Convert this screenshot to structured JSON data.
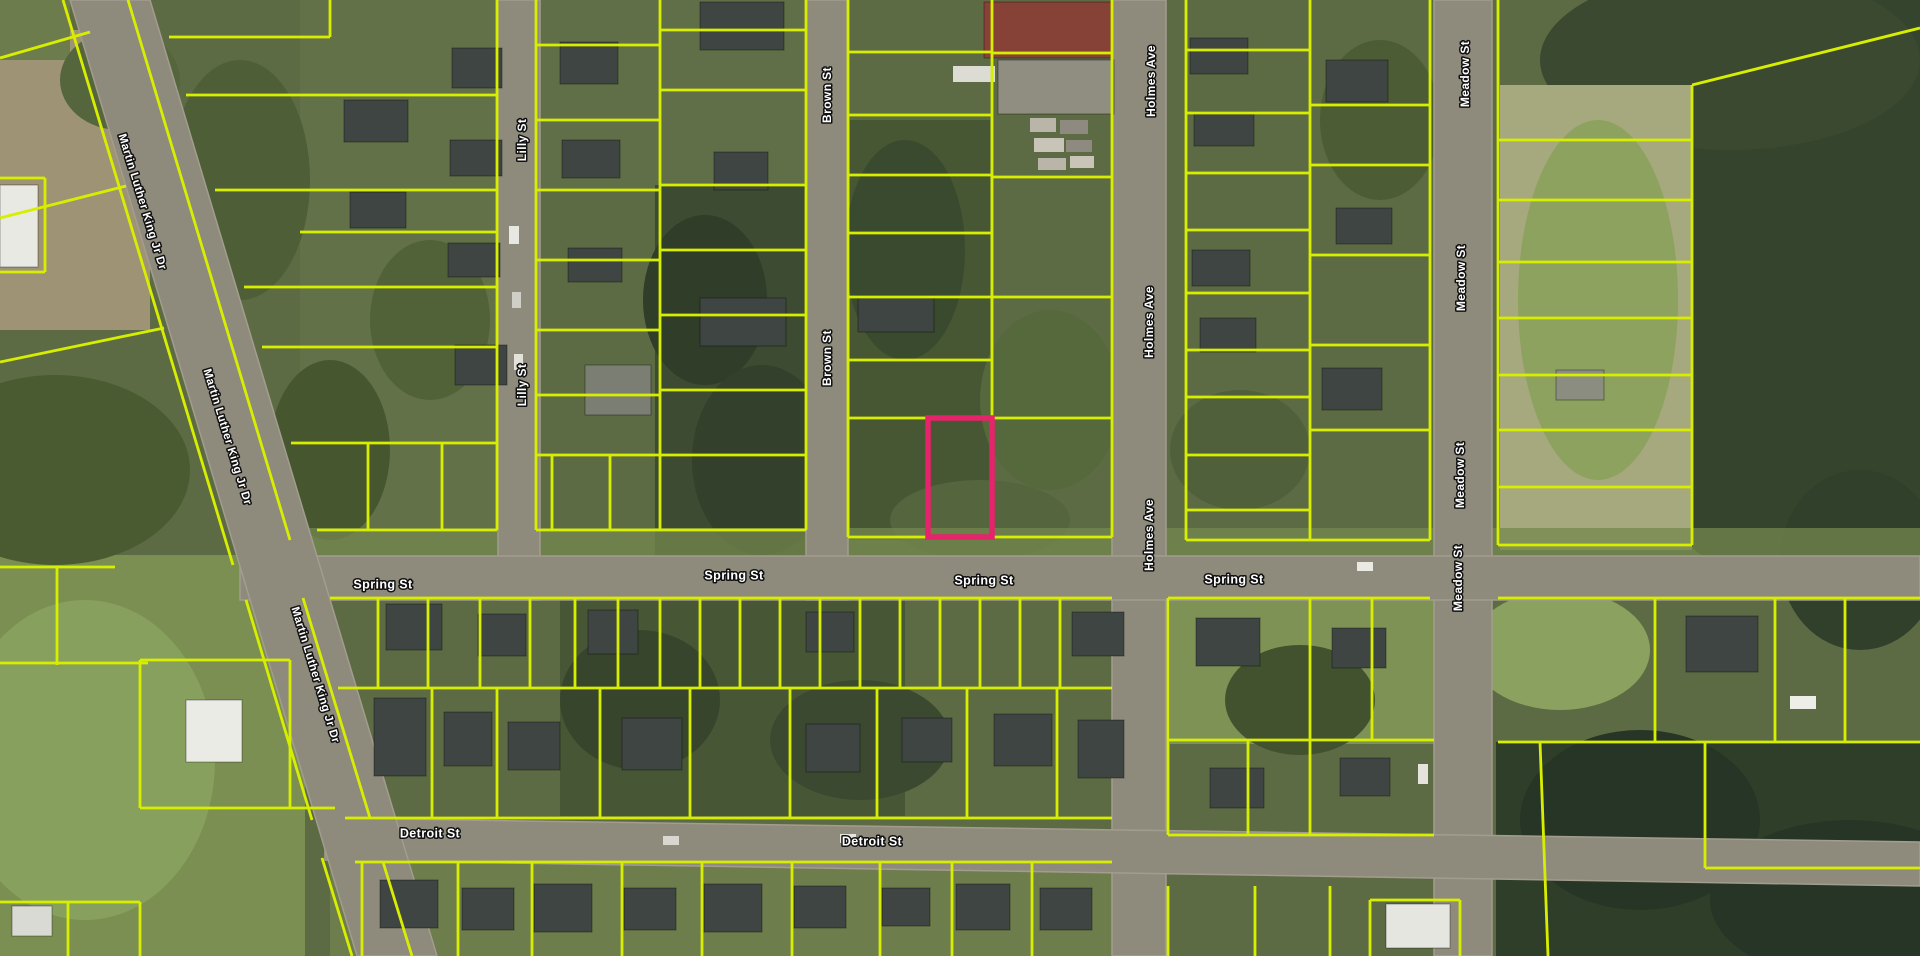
{
  "map_type": "satellite-parcel-map",
  "streets": [
    {
      "name": "Martin Luther King Jr Dr",
      "orientation": "diagonal"
    },
    {
      "name": "Lilly St",
      "orientation": "vertical"
    },
    {
      "name": "Brown St",
      "orientation": "vertical"
    },
    {
      "name": "Holmes Ave",
      "orientation": "vertical"
    },
    {
      "name": "Meadow St",
      "orientation": "vertical"
    },
    {
      "name": "Spring St",
      "orientation": "horizontal"
    },
    {
      "name": "Detroit St",
      "orientation": "horizontal"
    }
  ],
  "street_labels": [
    {
      "text": "Martin Luther King Jr Dr",
      "x": 142,
      "y": 202,
      "rot": 73,
      "size": 11.5
    },
    {
      "text": "Martin Luther King Jr Dr",
      "x": 227,
      "y": 437,
      "rot": 73,
      "size": 11.5
    },
    {
      "text": "Martin Luther King Jr Dr",
      "x": 315,
      "y": 675,
      "rot": 73,
      "size": 11.5
    },
    {
      "text": "Lilly St",
      "x": 523,
      "y": 140,
      "rot": -90,
      "size": 12
    },
    {
      "text": "Lilly St",
      "x": 523,
      "y": 385,
      "rot": -90,
      "size": 12
    },
    {
      "text": "Brown St",
      "x": 828,
      "y": 95,
      "rot": -90,
      "size": 12
    },
    {
      "text": "Brown St",
      "x": 828,
      "y": 358,
      "rot": -90,
      "size": 12
    },
    {
      "text": "Holmes Ave",
      "x": 1152,
      "y": 81,
      "rot": -90,
      "size": 12
    },
    {
      "text": "Holmes Ave",
      "x": 1150,
      "y": 322,
      "rot": -90,
      "size": 12
    },
    {
      "text": "Holmes Ave",
      "x": 1150,
      "y": 535,
      "rot": -90,
      "size": 12
    },
    {
      "text": "Meadow St",
      "x": 1466,
      "y": 74,
      "rot": -90,
      "size": 12
    },
    {
      "text": "Meadow St",
      "x": 1462,
      "y": 278,
      "rot": -90,
      "size": 12
    },
    {
      "text": "Meadow St",
      "x": 1461,
      "y": 475,
      "rot": -90,
      "size": 12
    },
    {
      "text": "Meadow St",
      "x": 1459,
      "y": 578,
      "rot": -90,
      "size": 12
    },
    {
      "text": "Spring St",
      "x": 383,
      "y": 585,
      "rot": 0,
      "size": 12.5
    },
    {
      "text": "Spring St",
      "x": 734,
      "y": 576,
      "rot": 0,
      "size": 12.5
    },
    {
      "text": "Spring St",
      "x": 984,
      "y": 581,
      "rot": 0,
      "size": 12.5
    },
    {
      "text": "Spring St",
      "x": 1234,
      "y": 580,
      "rot": 0,
      "size": 12.5
    },
    {
      "text": "Detroit St",
      "x": 430,
      "y": 834,
      "rot": 0,
      "size": 12.5
    },
    {
      "text": "Detroit St",
      "x": 872,
      "y": 842,
      "rot": 0,
      "size": 12.5
    }
  ],
  "highlight_parcel": {
    "x": 928,
    "y": 418,
    "width": 64,
    "height": 119
  },
  "colors": {
    "parcel_line": "#d8ee00",
    "highlight_line": "#e5246b",
    "road_fill": "#8e8a7c",
    "road_edge": "#a29d8e",
    "label_fill": "#ffffff",
    "label_halo": "#111111"
  }
}
